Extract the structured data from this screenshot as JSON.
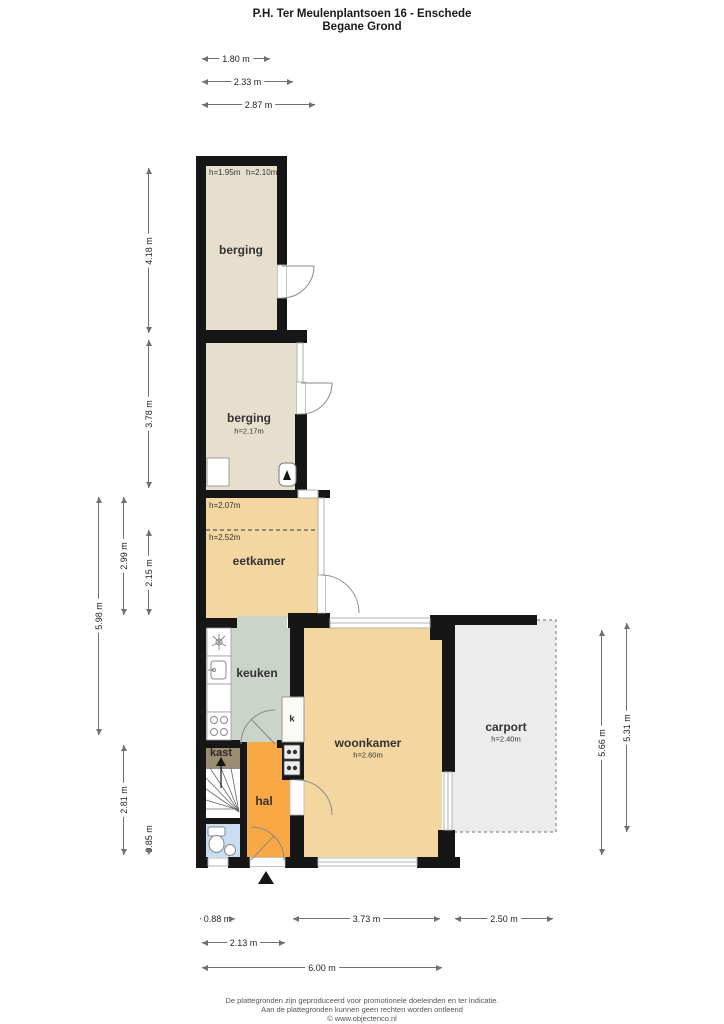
{
  "title": {
    "line1": "P.H. Ter Meulenplantsoen 16 - Enschede",
    "line2": "Begane Grond"
  },
  "rooms": {
    "berging1": {
      "name": "berging",
      "h1": "h=1.95m",
      "h2": "h=2.10m"
    },
    "berging2": {
      "name": "berging",
      "h": "h=2.17m"
    },
    "eetkamer": {
      "name": "eetkamer",
      "h_top": "h=2.07m",
      "h_mid": "h=2.52m"
    },
    "keuken": {
      "name": "keuken"
    },
    "kast": {
      "name": "kast"
    },
    "closet_k": {
      "name": "k"
    },
    "hal": {
      "name": "hal"
    },
    "woonkamer": {
      "name": "woonkamer",
      "h": "h=2.60m"
    },
    "carport": {
      "name": "carport",
      "h": "h=2.40m"
    }
  },
  "dimensions": {
    "top": [
      "1.80 m",
      "2.33 m",
      "2.87 m"
    ],
    "left_inner": [
      "4.18 m",
      "3.78 m",
      "2.15 m",
      "0.85 m"
    ],
    "left_mid": [
      "2.99 m",
      "2.81 m"
    ],
    "left_outer": [
      "5.98 m"
    ],
    "right": [
      "5.66 m",
      "5.31 m"
    ],
    "bottom_row1": [
      "0.88 m",
      "3.73 m",
      "2.50 m"
    ],
    "bottom_row2": [
      "2.13 m"
    ],
    "bottom_row3": [
      "6.00 m"
    ]
  },
  "footer": {
    "line1": "De plattegronden zijn geproduceerd voor promotionele doeleinden en ter indicatie.",
    "line2": "Aan de plattegronden kunnen geen rechten worden ontleend",
    "line3": "© www.objectenco.nl"
  },
  "colors": {
    "wall": "#161616",
    "berging_floor": "#e6dfcd",
    "living_floor": "#f4d7a0",
    "hal_floor": "#f8a845",
    "keuken_floor": "#cbd4c9",
    "kast_floor": "#9b8d72",
    "toilet_floor": "#c9def0",
    "carport_floor": "#ececec"
  }
}
